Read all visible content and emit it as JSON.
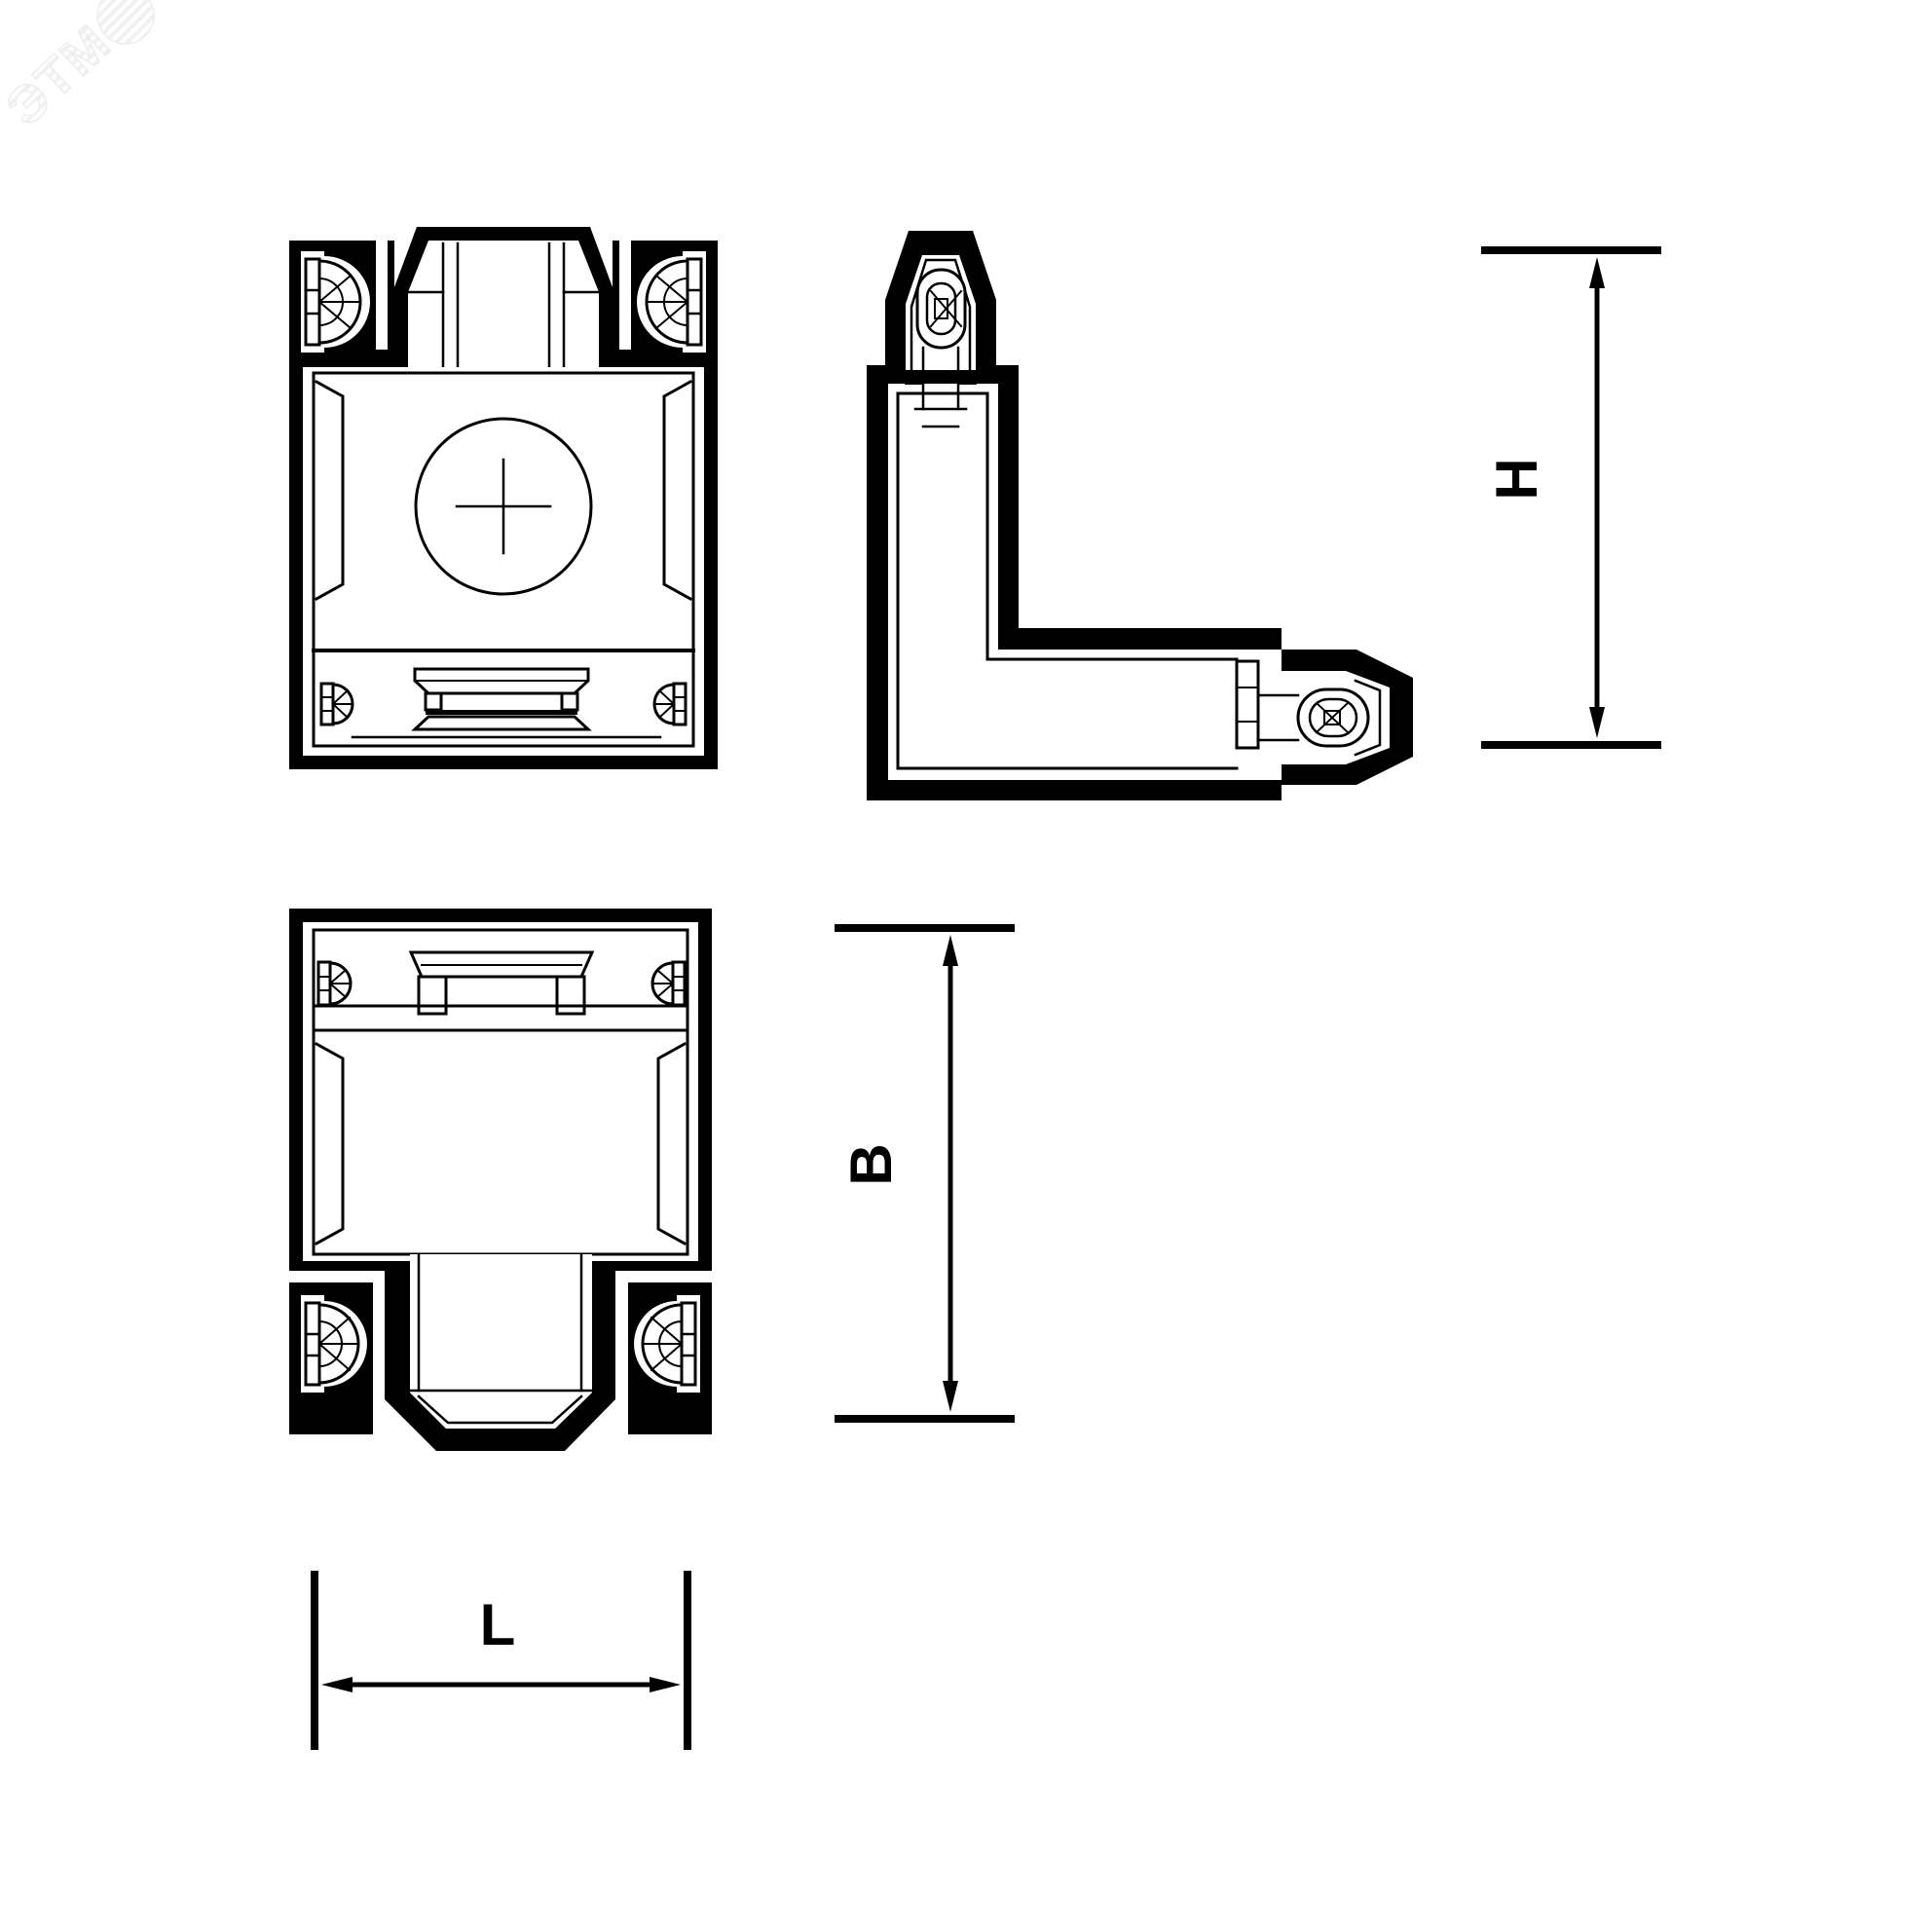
{
  "drawing": {
    "type": "technical-drawing",
    "subject": "track-connector-L-shaped",
    "line_color": "#000000",
    "background_color": "#ffffff"
  },
  "watermark": {
    "text": "ЭТМ",
    "color": "#f0f0f0"
  },
  "dimensions": {
    "h": {
      "label": "H"
    },
    "b": {
      "label": "B"
    },
    "l": {
      "label": "L"
    }
  }
}
